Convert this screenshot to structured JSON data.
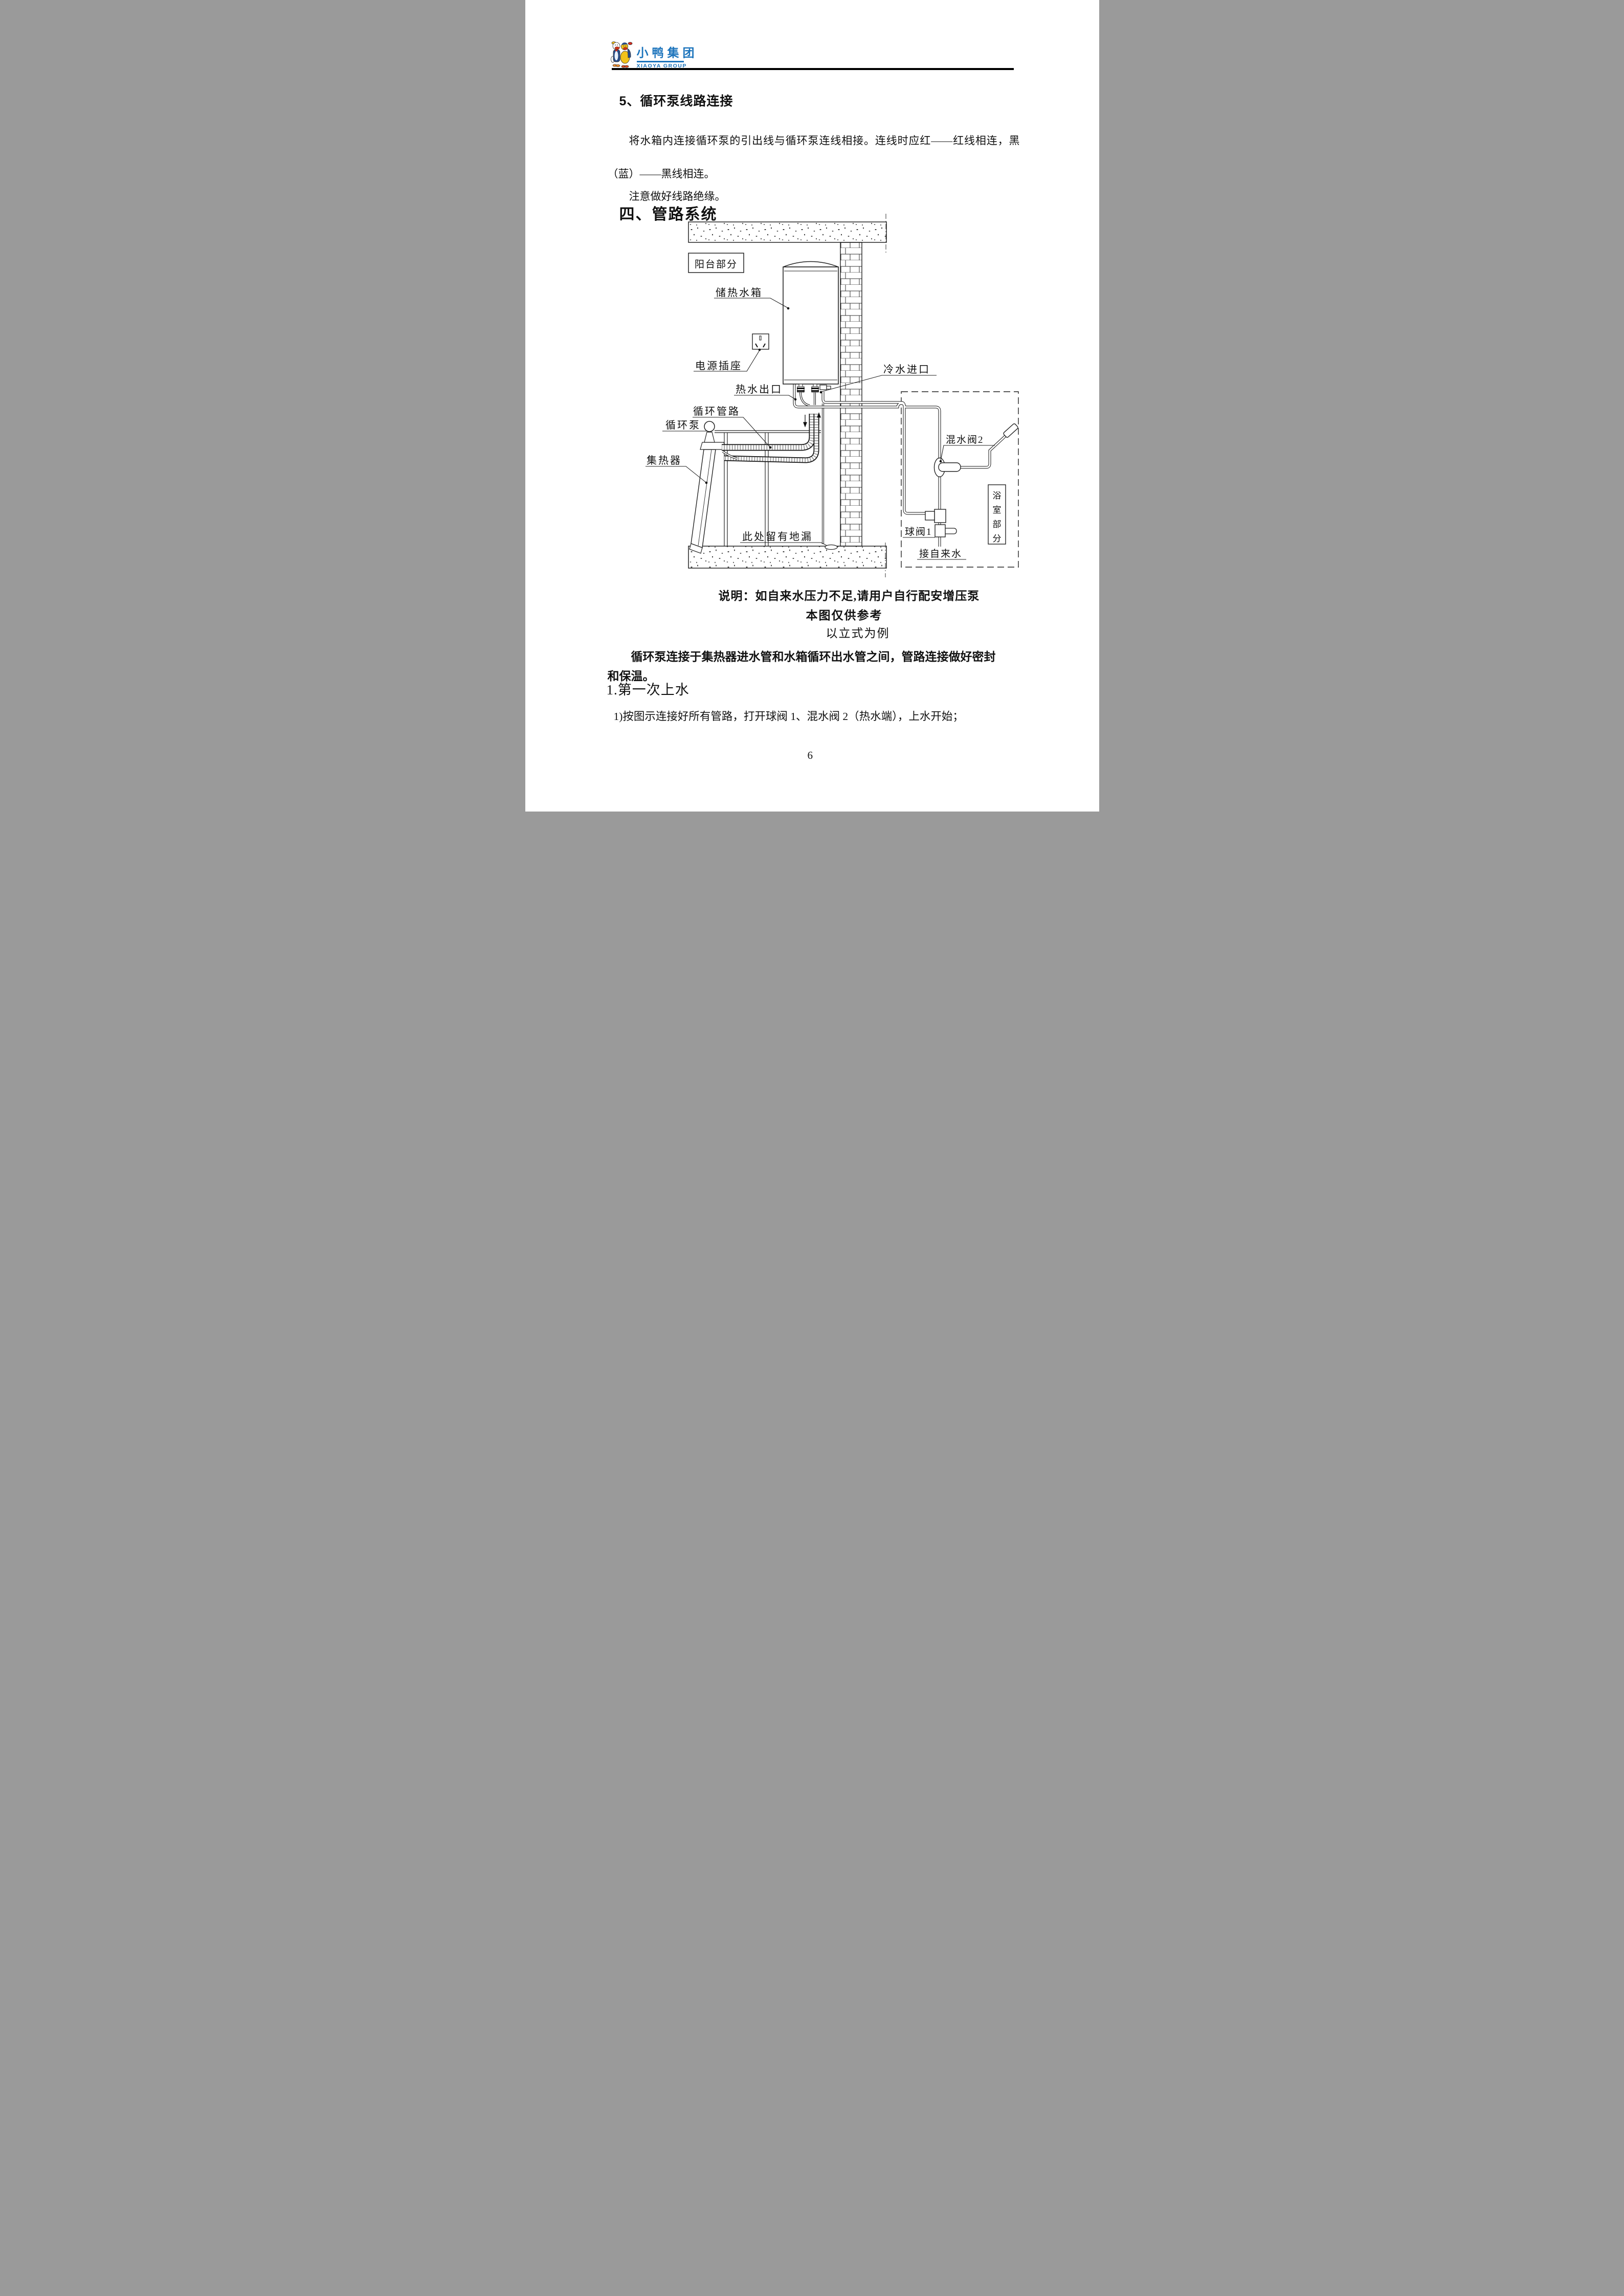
{
  "logo": {
    "cn": "小鸭集团",
    "en": "XIAOYA GROUP"
  },
  "section5": {
    "title": "5、循环泵线路连接",
    "para": "将水箱内连接循环泵的引出线与循环泵连线相接。连线时应红——红线相连，黑（蓝）——黑线相连。",
    "note": "注意做好线路绝缘。"
  },
  "section4": {
    "title": "四、管路系统"
  },
  "diagram": {
    "labels": {
      "balcony": "阳台部分",
      "tank": "储热水箱",
      "socket": "电源插座",
      "hot_out": "热水出口",
      "cold_in": "冷水进口",
      "circ_pipe": "循环管路",
      "circ_pump": "循环泵",
      "collector": "集热器",
      "floor_drain": "此处留有地漏",
      "mix_valve": "混水阀2",
      "ball_valve": "球阀1",
      "tap_water": "接自来水",
      "bathroom": [
        "浴",
        "室",
        "部",
        "分"
      ]
    }
  },
  "caption": {
    "line1": "说明：如自来水压力不足,请用户自行配安增压泵",
    "line2": "本图仅供参考",
    "line3": "以立式为例"
  },
  "body": {
    "para_bold": "循环泵连接于集热器进水管和水箱循环出水管之间，管路连接做好密封和保温。",
    "subsection": "1.第一次上水",
    "step1": "1)按图示连接好所有管路，打开球阀 1、混水阀 2（热水端），上水开始；"
  },
  "page_number": "6",
  "colors": {
    "brand_blue": "#1c74bc",
    "ink": "#111111"
  }
}
